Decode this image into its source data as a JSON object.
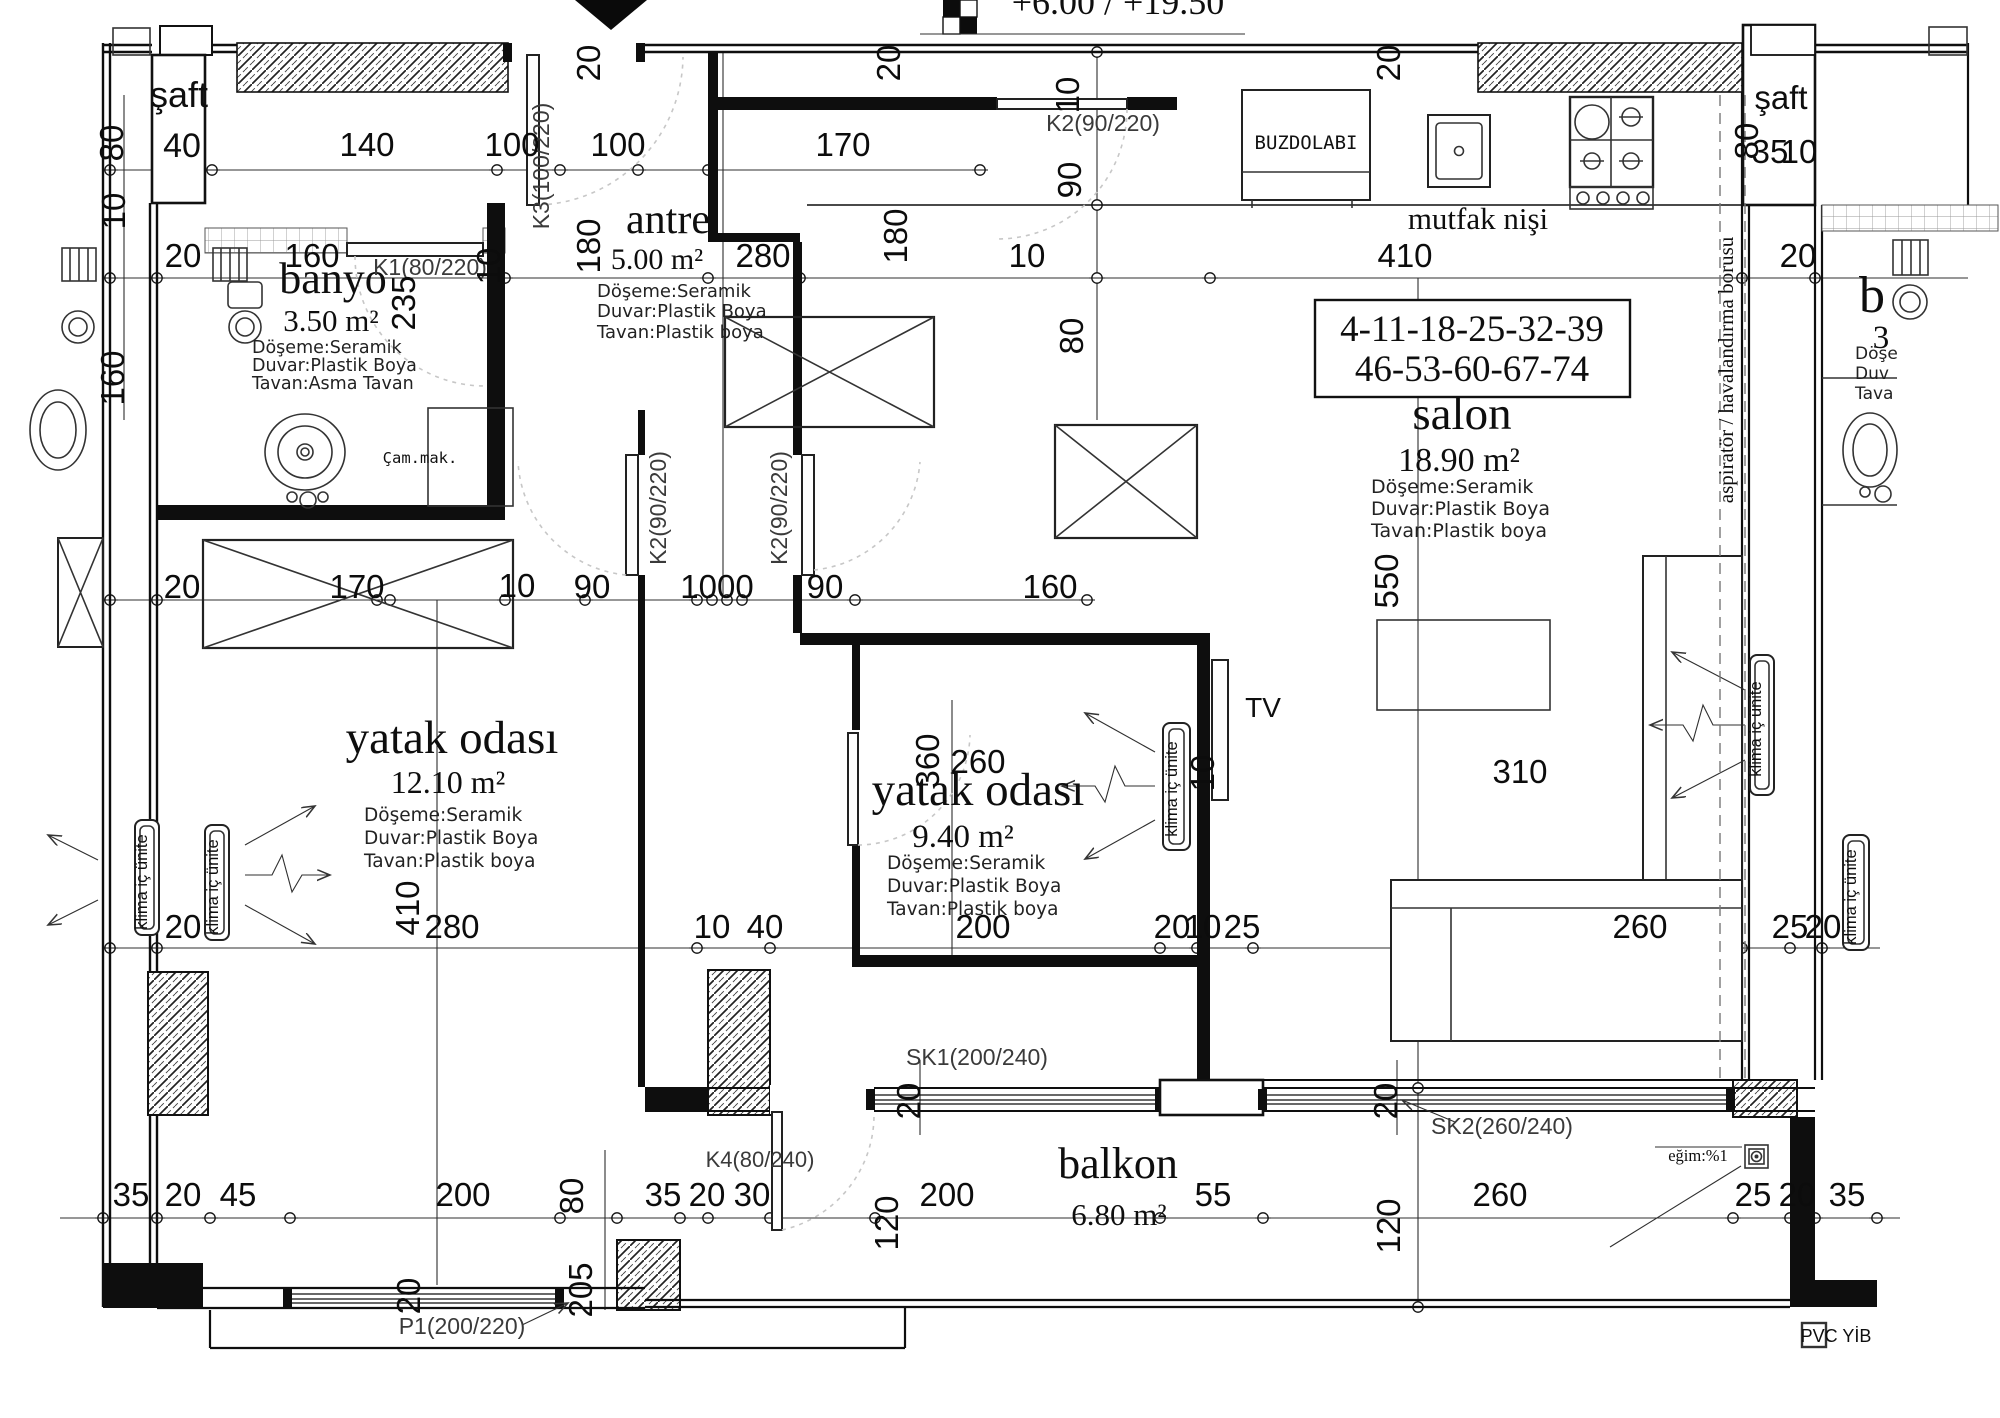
{
  "elevation": {
    "text": "+6.00 / +19.50"
  },
  "unit_numbers": {
    "line1": "4-11-18-25-32-39",
    "line2": "46-53-60-67-74"
  },
  "rooms": {
    "banyo": {
      "name": "banyo",
      "area": "3.50 m²",
      "floor": "Döşeme:Seramik",
      "wall": "Duvar:Plastik Boya",
      "ceiling": "Tavan:Asma Tavan"
    },
    "antre": {
      "name": "antre",
      "area": "5.00 m²",
      "floor": "Döşeme:Seramik",
      "wall": "Duvar:Plastik Boya",
      "ceiling": "Tavan:Plastik boya"
    },
    "mutfak": {
      "name": "mutfak nişi"
    },
    "salon": {
      "name": "salon",
      "area": "18.90 m²",
      "floor": "Döşeme:Seramik",
      "wall": "Duvar:Plastik Boya",
      "ceiling": "Tavan:Plastik boya"
    },
    "yatak1": {
      "name": "yatak odası",
      "area": "12.10 m²",
      "floor": "Döşeme:Seramik",
      "wall": "Duvar:Plastik Boya",
      "ceiling": "Tavan:Plastik boya"
    },
    "yatak2": {
      "name": "yatak odası",
      "area": "9.40 m²",
      "floor": "Döşeme:Seramik",
      "wall": "Duvar:Plastik Boya",
      "ceiling": "Tavan:Plastik boya"
    },
    "balkon": {
      "name": "balkon",
      "area": "6.80 m²"
    },
    "saft_left": {
      "name": "şaft",
      "dim": "40"
    },
    "saft_right": {
      "name": "şaft"
    },
    "neighbor": {
      "room_partial": "b",
      "area_partial": "3",
      "floor_partial": "Döşe",
      "wall_partial": "Duv",
      "ceiling_partial": "Tava"
    }
  },
  "doors": {
    "k1": "K1(80/220)",
    "k2": "K2(90/220)",
    "k3": "K3(100/220)",
    "k4": "K4(80/240)",
    "sk1": "SK1(200/240)",
    "sk2": "SK2(260/240)",
    "p1": "P1(200/220)"
  },
  "labels": {
    "buzdolabi": "BUZDOLABI",
    "cam_mak": "Çam.mak.",
    "tv": "TV",
    "klima": "klima iç ünite",
    "aspirator": "aspiratör / havalandırma borusu",
    "egim": "eğim:%1",
    "pvc": "PVC YİB"
  },
  "dims": {
    "top_thickness": [
      "20",
      "20",
      "20"
    ],
    "left_col": [
      "80",
      "10",
      "160"
    ],
    "top_widths": [
      "140",
      "100",
      "100",
      "170"
    ],
    "row_a": [
      "20",
      "160",
      "10",
      "280",
      "10",
      "410",
      "20"
    ],
    "banyo_v": "235",
    "antre_v": "180",
    "closet_v": "180",
    "kitchen_col": [
      "10",
      "90",
      "80"
    ],
    "row_mid": [
      "20",
      "170",
      "10",
      "90",
      "1000",
      "90",
      "160"
    ],
    "yatak2_top": [
      "360",
      "260",
      "10"
    ],
    "salon_v": [
      "550",
      "310"
    ],
    "yatak1_v": "410",
    "row_lower": [
      "20",
      "280",
      "10",
      "40",
      "200",
      "20",
      "10",
      "25",
      "260",
      "25",
      "20"
    ],
    "row_bottom": [
      "35",
      "20",
      "45",
      "200",
      "35",
      "20",
      "30",
      "200",
      "55",
      "260",
      "25",
      "20",
      "35"
    ],
    "bottom_v": [
      "80",
      "120",
      "120",
      "205",
      "20",
      "20",
      "20"
    ],
    "saft_right_col": [
      "80",
      "35",
      "10"
    ]
  }
}
